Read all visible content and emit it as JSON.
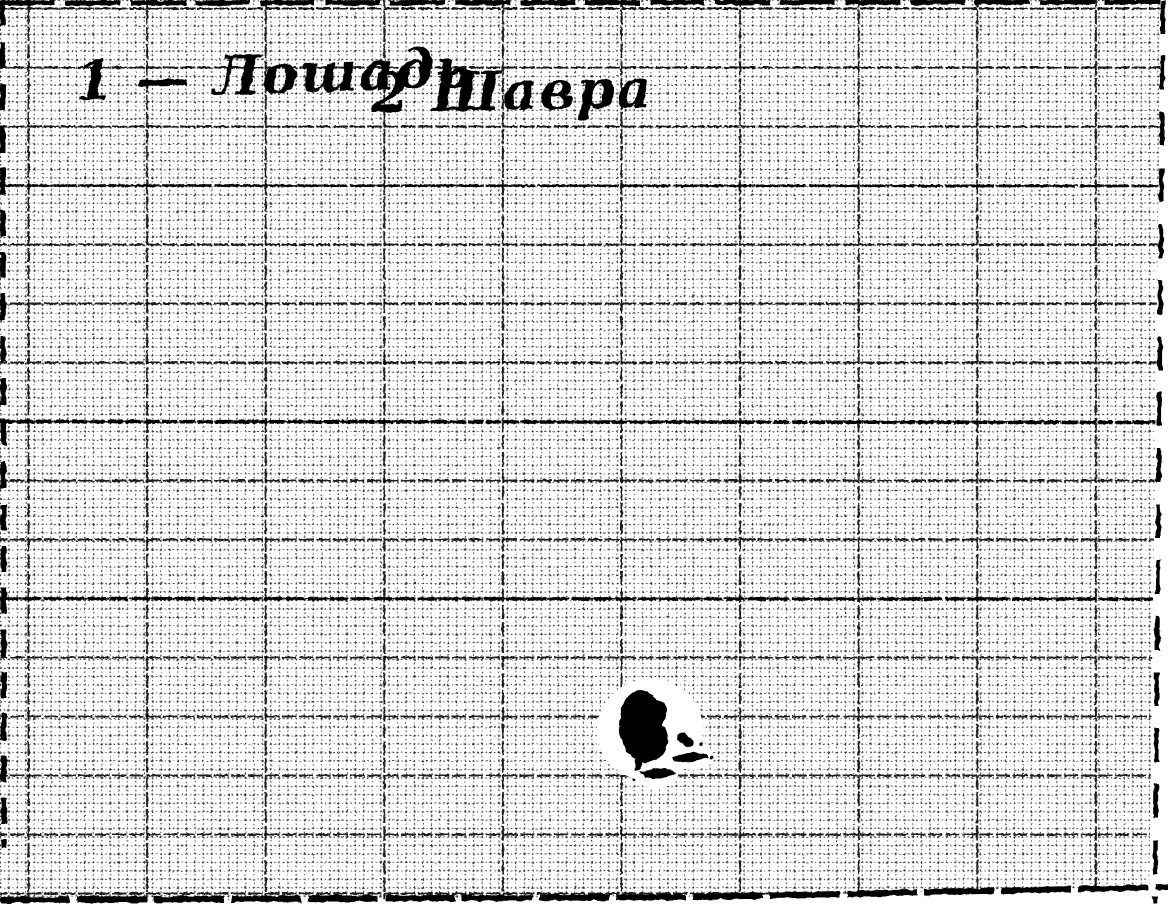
{
  "document": {
    "kind": "scanned graph-paper sheet with handwritten caption and ink blot"
  },
  "caption": {
    "figure1": "1 — Лошадь",
    "figure2": "2 Шавра"
  },
  "colors": {
    "paper": "#ffffff",
    "ink": "#000000"
  }
}
